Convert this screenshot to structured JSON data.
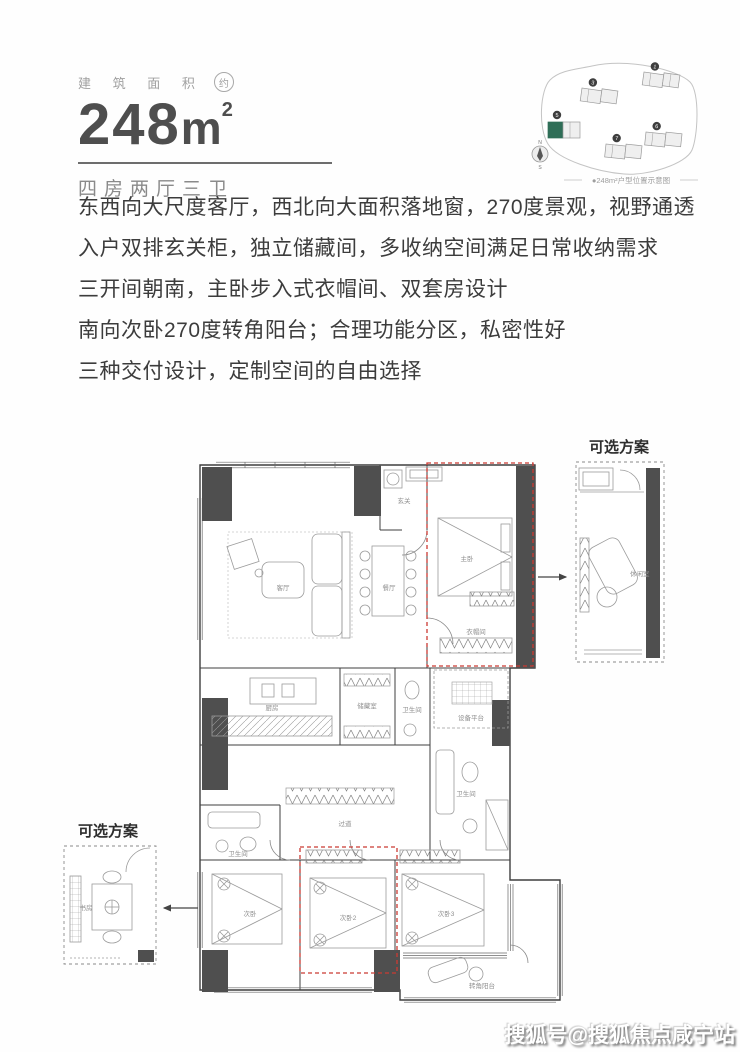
{
  "header": {
    "area_label": "建 筑 面 积",
    "area_approx": "约",
    "area_value": "248",
    "area_unit": "m",
    "area_sup": "2",
    "layout_label": "四房两厅三卫"
  },
  "siteplan": {
    "caption": "●248m²户型位置示意图",
    "compass_n": "N",
    "compass_s": "S",
    "building_numbers": [
      "1",
      "3",
      "5",
      "7",
      "6"
    ]
  },
  "description": {
    "lines": [
      "东西向大尺度客厅，西北向大面积落地窗，270度景观，视野通透",
      "入户双排玄关柜，独立储藏间，多收纳空间满足日常收纳需求",
      "三开间朝南，主卧步入式衣帽间、双套房设计",
      "南向次卧270度转角阳台；合理功能分区，私密性好",
      "三种交付设计，定制空间的自由选择"
    ]
  },
  "floorplan": {
    "option_right_title": "可选方案",
    "option_left_title": "可选方案",
    "rooms": {
      "living": "客厅",
      "dining": "餐厅",
      "entry": "玄关",
      "master": "主卧",
      "closet": "衣帽间",
      "kitchen": "厨房",
      "storage": "储藏室",
      "bath_center": "卫生间",
      "equipment": "设备平台",
      "bath_master": "卫生间",
      "corridor": "过道",
      "bath_left": "卫生间",
      "bed1": "次卧",
      "bed2": "次卧2",
      "bed3": "次卧3",
      "balcony": "转角阳台",
      "option_right_room": "休闲室",
      "option_left_room": "书房"
    }
  },
  "watermark": "搜狐号@搜狐焦点咸宁站",
  "colors": {
    "accent_red": "#cb3a33",
    "wall_dark": "#4f4f4f",
    "highlight_green": "#2f6e57"
  }
}
